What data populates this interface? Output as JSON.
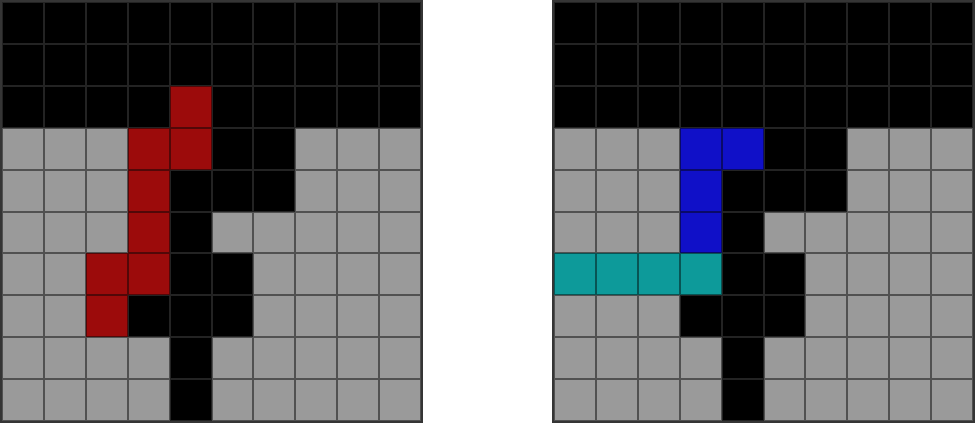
{
  "palette": {
    "k": {
      "name": "black",
      "hex": "#000000"
    },
    "g": {
      "name": "gray",
      "hex": "#9a9a9a"
    },
    "r": {
      "name": "dark-red",
      "hex": "#9c0b0b"
    },
    "b": {
      "name": "blue",
      "hex": "#1010c8"
    },
    "t": {
      "name": "teal",
      "hex": "#0d9a9a"
    }
  },
  "grids": {
    "left": {
      "label": "left-puzzle-grid",
      "rows": 10,
      "cols": 10,
      "cells": [
        "kkkkkkkkkk",
        "kkkkkkkkkk",
        "kkkkrkkkkk",
        "gggrrkkggg",
        "gggrkkkggg",
        "gggrkggggg",
        "ggrrkkgggg",
        "ggrkkkgggg",
        "ggggkggggg",
        "ggggkggggg"
      ]
    },
    "right": {
      "label": "right-puzzle-grid",
      "rows": 10,
      "cols": 10,
      "cells": [
        "kkkkkkkkkk",
        "kkkkkkkkkk",
        "kkkkkkkkkk",
        "gggbbkkggg",
        "gggbkkkggg",
        "gggbkggggg",
        "ttttkkgggg",
        "gggkkkgggg",
        "ggggkggggg",
        "ggggkggggg"
      ]
    }
  }
}
